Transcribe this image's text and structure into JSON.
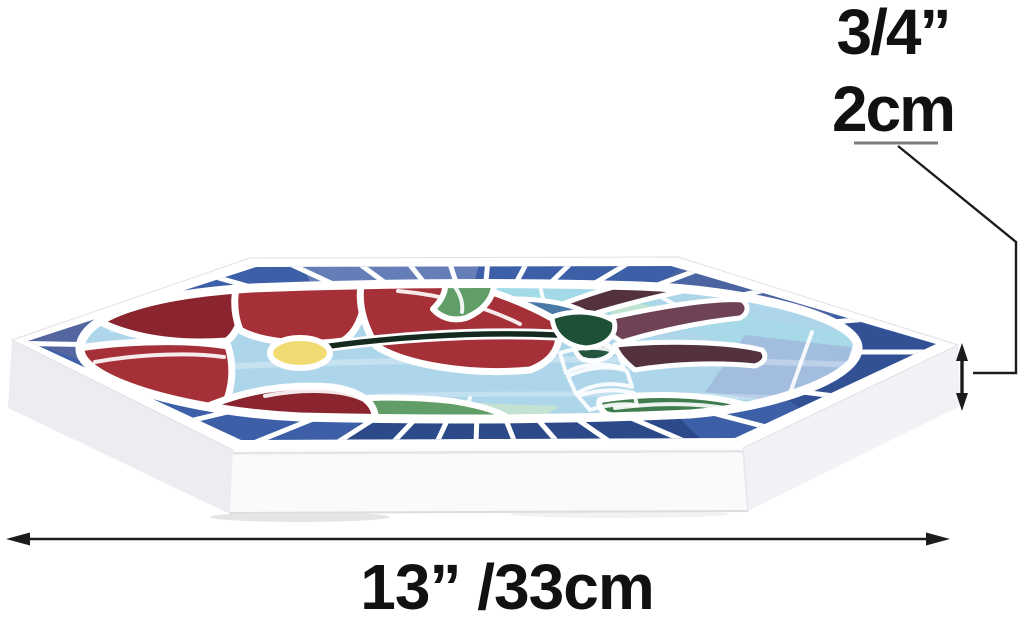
{
  "figure": {
    "alt": "Hexagonal stained-glass mosaic stepping stone with red flower and hummingbird design, shown at an angle with dimension callouts"
  },
  "annotations": {
    "thickness": {
      "inches": "3/4”",
      "cm": "2cm"
    },
    "width": {
      "label": "13” /33cm"
    }
  },
  "palette": {
    "grout": "#ffffff",
    "border_blue": "#3c5fa8",
    "border_blue_dark": "#27437f",
    "border_blue_light": "#7388be",
    "border_blue_slate": "#55679f",
    "bg_sky": "#aed6ea",
    "bg_aqua": "#a2dbe8",
    "bg_lavender": "#c2a3cc",
    "bg_pink": "#c48fb8",
    "bg_periwinkle": "#9fb7db",
    "bg_mint": "#cde7c8",
    "flower_red": "#a53038",
    "flower_red_dark": "#8a242e",
    "flower_center_yellow": "#f1dc74",
    "leaf_green": "#619d67",
    "leaf_green_dark": "#3e7c4d",
    "forest_green": "#1e5037",
    "bird_blue": "#4a79a8",
    "wing_maroon": "#6f4255",
    "wing_maroon_dark": "#54313f",
    "belly_orange": "#e08130",
    "belly_orange_dark": "#d0661f",
    "beak_dark": "#142a1e",
    "stone_white": "#fafafb",
    "stone_shadow": "#ececf1",
    "dimension_line": "#1c1c1c",
    "underline_gray": "#7d7d7d",
    "text_black": "#111111"
  }
}
